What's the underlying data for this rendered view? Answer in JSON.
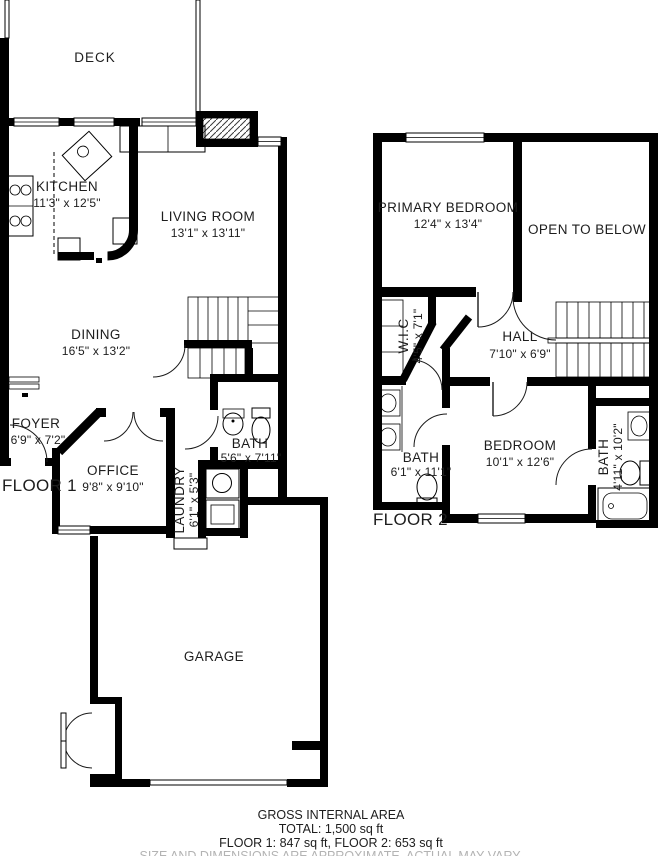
{
  "colors": {
    "wall": "#000000",
    "text": "#1d1d1d",
    "muted_text": "#b3b3b3"
  },
  "floor1": {
    "label": "FLOOR 1",
    "deck": {
      "label": "DECK"
    },
    "kitchen": {
      "label": "KITCHEN",
      "dims": "11'3\" x 12'5\""
    },
    "living_room": {
      "label": "LIVING ROOM",
      "dims": "13'1\" x 13'11\""
    },
    "dining": {
      "label": "DINING",
      "dims": "16'5\" x 13'2\""
    },
    "foyer": {
      "label": "FOYER",
      "dims": "6'9\" x 7'2\""
    },
    "office": {
      "label": "OFFICE",
      "dims": "9'8\" x 9'10\""
    },
    "bath": {
      "label": "BATH",
      "dims": "5'6\" x 7'11\""
    },
    "laundry": {
      "label": "LAUNDRY",
      "dims": "6'1\" x 5'3\""
    },
    "garage": {
      "label": "GARAGE"
    }
  },
  "floor2": {
    "label": "FLOOR 2",
    "primary_bedroom": {
      "label": "PRIMARY BEDROOM",
      "dims": "12'4\" x 13'4\""
    },
    "open_to_below": {
      "label": "OPEN TO BELOW"
    },
    "wic": {
      "label": "W.I.C",
      "dims": "4'5\" x 7'1\""
    },
    "hall": {
      "label": "HALL",
      "dims": "7'10\" x 6'9\""
    },
    "bath": {
      "label": "BATH",
      "dims": "6'1\" x 11'1\""
    },
    "bedroom": {
      "label": "BEDROOM",
      "dims": "10'1\" x 12'6\""
    },
    "bath2": {
      "label": "BATH",
      "dims": "4'11\" x 10'2\""
    }
  },
  "footer": {
    "title": "GROSS INTERNAL AREA",
    "total": "TOTAL: 1,500 sq ft",
    "floors": "FLOOR 1: 847 sq ft, FLOOR 2: 653 sq ft",
    "disclaimer": "SIZE AND DIMENSIONS ARE APPROXIMATE, ACTUAL MAY VARY."
  }
}
